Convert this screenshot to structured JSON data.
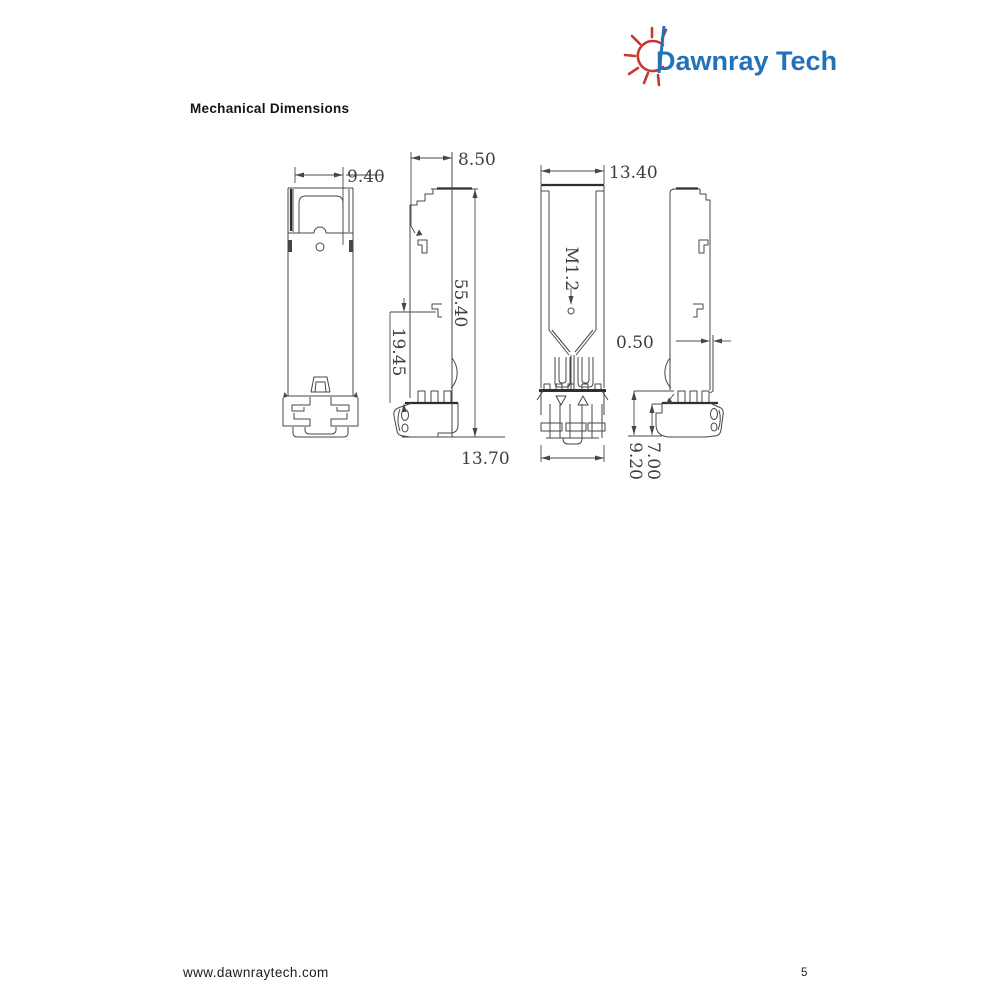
{
  "logo": {
    "text": "Dawnray Tech",
    "icon": "sun-rays-icon",
    "brand_color": "#2272B9",
    "sun_color": "#C8372D"
  },
  "heading": "Mechanical Dimensions",
  "drawing": {
    "description": "Four orthographic views of SFP transceiver module",
    "dims": {
      "d940": "9.40",
      "d850": "8.50",
      "d5540": "55.40",
      "d1945": "19.45",
      "d1340": "13.40",
      "d1370": "13.70",
      "m12": "M1.2",
      "d050": "0.50",
      "d700": "7.00",
      "d920": "9.20"
    }
  },
  "footer": {
    "website": "www.dawnraytech.com",
    "page_number": "5"
  }
}
